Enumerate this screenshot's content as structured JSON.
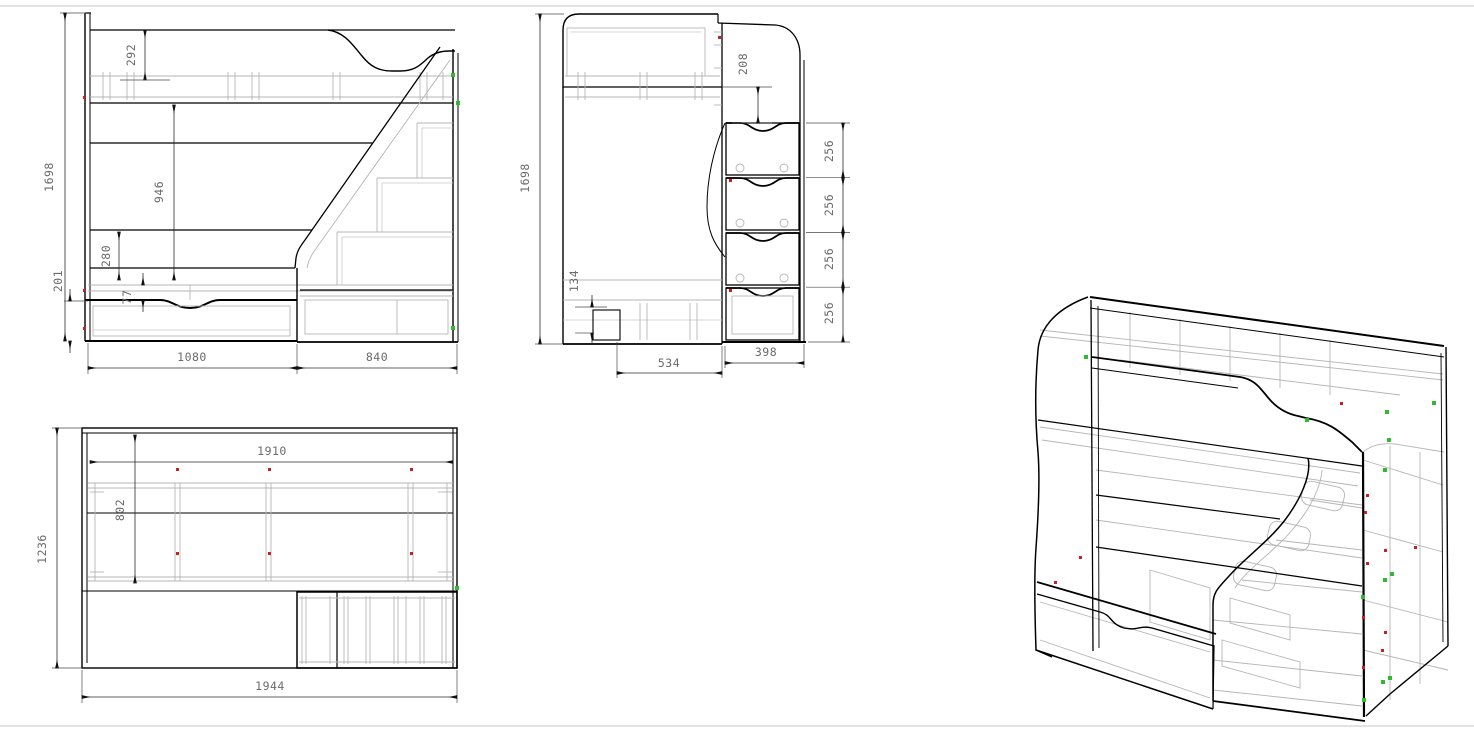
{
  "dims": {
    "front": {
      "total_height": "1698",
      "guard_rail_height": "292",
      "bunk_clearance": "946",
      "under_bunk": "280",
      "base_height": "201",
      "drawer_gap": "77",
      "bed_width": "1080",
      "stairs_width": "840"
    },
    "side": {
      "total_height": "1698",
      "rail_to_step": "208",
      "step_rise_1": "256",
      "step_rise_2": "256",
      "step_rise_3": "256",
      "step_rise_4": "256",
      "foot_height": "134",
      "bed_depth": "534",
      "stairs_depth": "398"
    },
    "plan": {
      "total_depth": "1236",
      "inner_length": "1910",
      "inner_depth": "802",
      "total_length": "1944"
    }
  },
  "colors": {
    "line": "#000000",
    "aux_line": "#b5b5b5",
    "dim_text": "#6b6b6b",
    "marker_green": "#2fbb2f",
    "marker_red": "#c42222",
    "frame": "#d9d9d9"
  }
}
